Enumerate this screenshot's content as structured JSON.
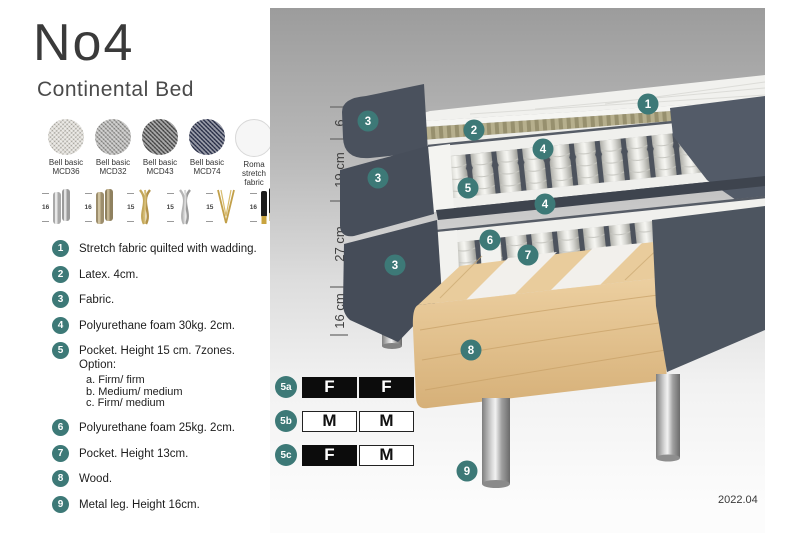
{
  "title": "No4",
  "subtitle": "Continental Bed",
  "fabrics": [
    {
      "line1": "Bell basic",
      "line2": "MCD36",
      "base": "#dad7d0"
    },
    {
      "line1": "Bell basic",
      "line2": "MCD32",
      "base": "#a7a6a4"
    },
    {
      "line1": "Bell basic",
      "line2": "MCD43",
      "base": "#575757"
    },
    {
      "line1": "Bell basic",
      "line2": "MCD74",
      "base": "#353b55"
    },
    {
      "line1": "Roma",
      "line2": "stretch fabric",
      "base": "#f6f6f6"
    }
  ],
  "legs": [
    {
      "height": "16",
      "style": "cylinder-chrome"
    },
    {
      "height": "16",
      "style": "cylinder-bronze"
    },
    {
      "height": "15",
      "style": "twist-gold"
    },
    {
      "height": "15",
      "style": "twist-silver"
    },
    {
      "height": "15",
      "style": "hairpin-gold"
    },
    {
      "height": "16",
      "style": "cylinder-black-gold"
    }
  ],
  "spec": [
    {
      "num": "1",
      "text": "Stretch fabric quilted with wadding."
    },
    {
      "num": "2",
      "text": "Latex. 4cm."
    },
    {
      "num": "3",
      "text": "Fabric."
    },
    {
      "num": "4",
      "text": "Polyurethane foam 30kg. 2cm."
    },
    {
      "num": "5",
      "text": "Pocket. Height 15 cm. 7zones. Option:",
      "options": [
        "a. Firm/ firm",
        "b. Medium/ medium",
        "c. Firm/ medium"
      ]
    },
    {
      "num": "6",
      "text": "Polyurethane foam 25kg. 2cm."
    },
    {
      "num": "7",
      "text": "Pocket. Height 13cm."
    },
    {
      "num": "8",
      "text": "Wood."
    },
    {
      "num": "9",
      "text": "Metal leg. Height 16cm."
    }
  ],
  "diagram": {
    "dimensions": [
      {
        "label": "6"
      },
      {
        "label": "19 cm"
      },
      {
        "label": "27 cm"
      },
      {
        "label": "16 cm"
      }
    ],
    "callouts": [
      {
        "label": "1"
      },
      {
        "label": "2"
      },
      {
        "label": "3"
      },
      {
        "label": "3"
      },
      {
        "label": "3"
      },
      {
        "label": "4"
      },
      {
        "label": "4"
      },
      {
        "label": "5"
      },
      {
        "label": "6"
      },
      {
        "label": "7"
      },
      {
        "label": "8"
      },
      {
        "label": "9"
      }
    ]
  },
  "firmness": [
    {
      "id": "5a",
      "cells": [
        {
          "letter": "F",
          "variant": "dark"
        },
        {
          "letter": "F",
          "variant": "dark"
        }
      ]
    },
    {
      "id": "5b",
      "cells": [
        {
          "letter": "M",
          "variant": "light"
        },
        {
          "letter": "M",
          "variant": "light"
        }
      ]
    },
    {
      "id": "5c",
      "cells": [
        {
          "letter": "F",
          "variant": "dark"
        },
        {
          "letter": "M",
          "variant": "light"
        }
      ]
    }
  ],
  "footer": {
    "version": "2022.04"
  },
  "colors": {
    "accent": "#3D7977",
    "fabric_dark": "#4e5663",
    "wood": "#e9cc9c",
    "latex": "#b6af8d"
  }
}
